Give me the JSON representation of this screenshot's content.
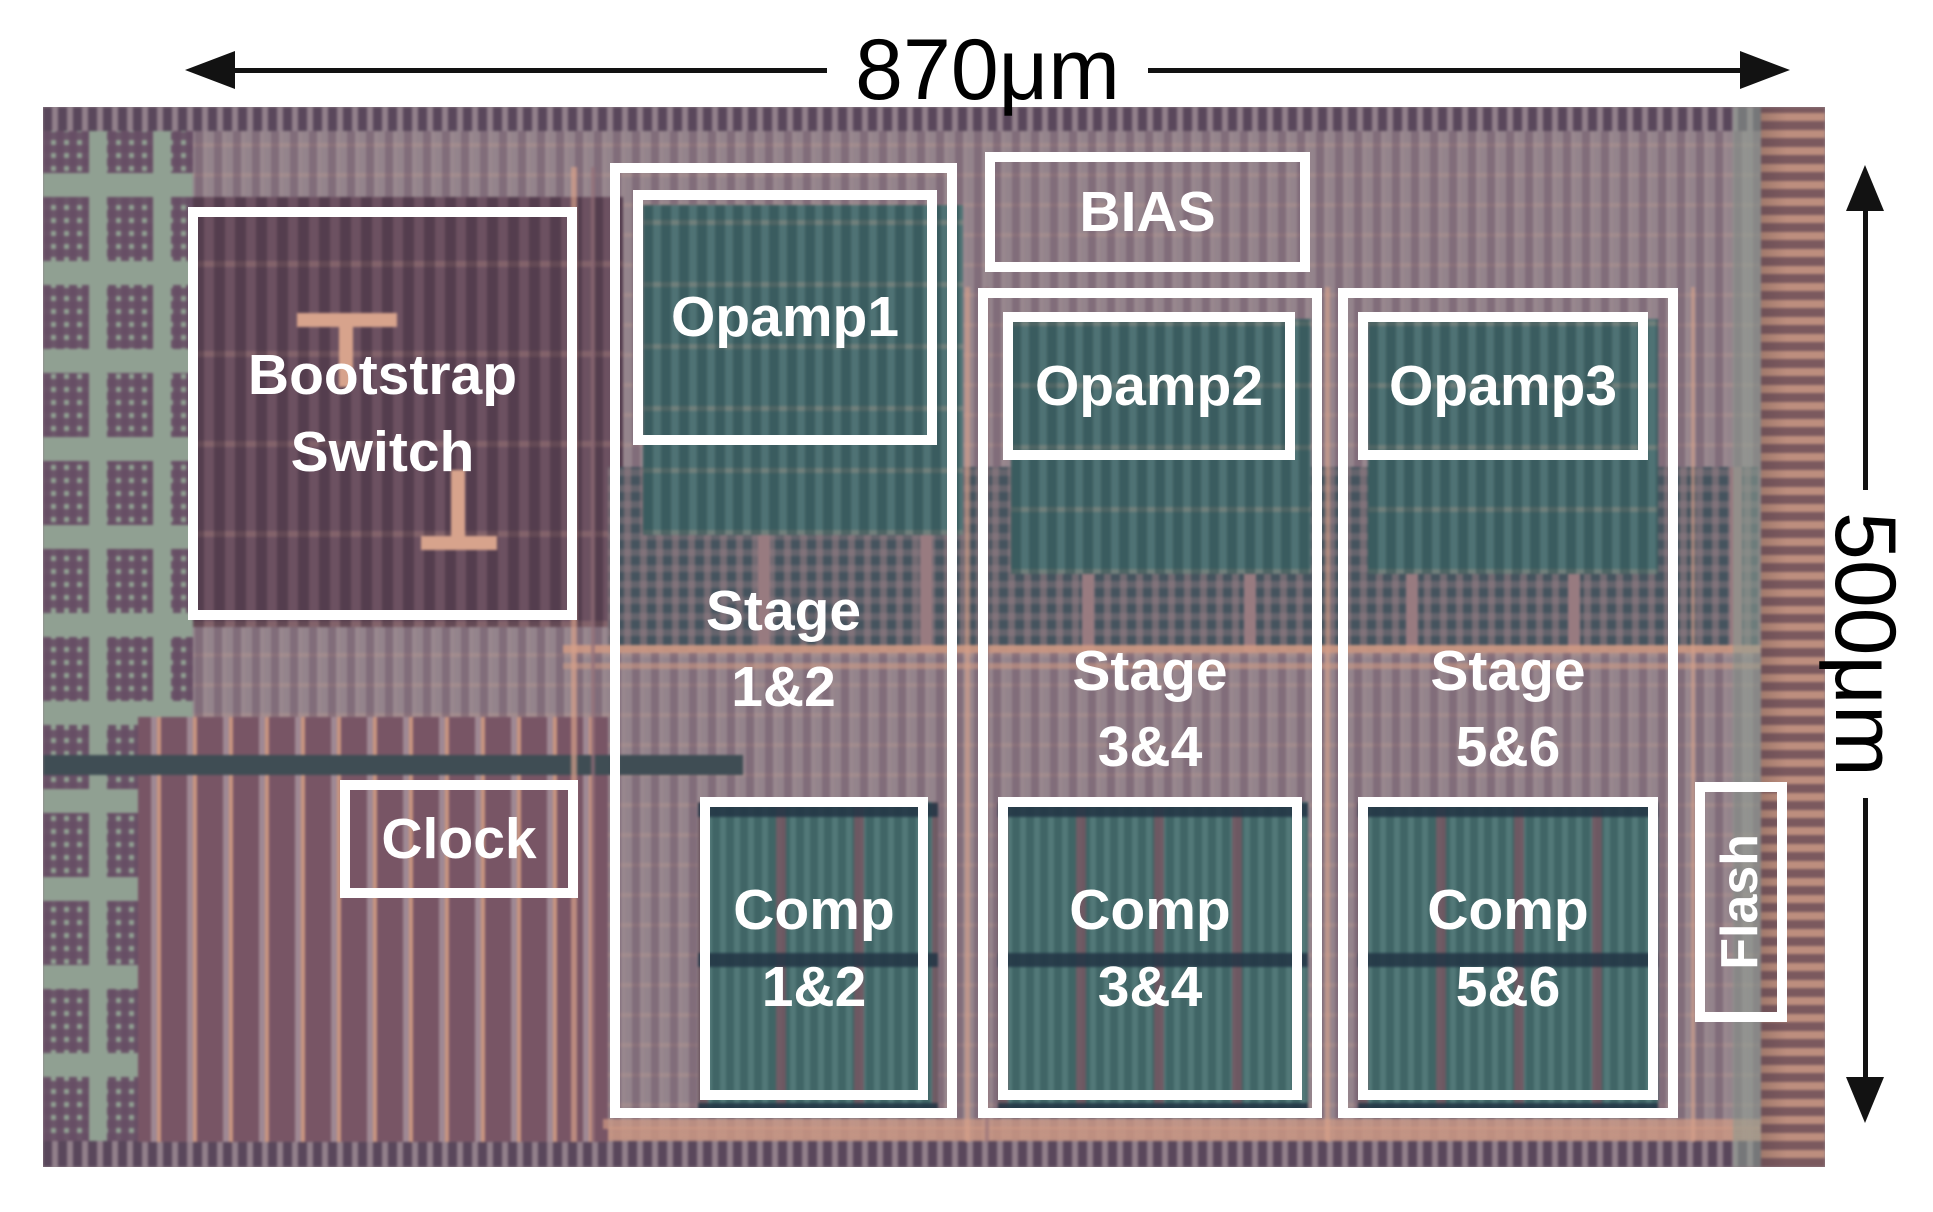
{
  "dimensions": {
    "width": "870μm",
    "height": "500μm"
  },
  "regions": {
    "bootstrap_switch": "Bootstrap\nSwitch",
    "clock": "Clock",
    "bias": "BIAS",
    "opamp1": "Opamp1",
    "opamp2": "Opamp2",
    "opamp3": "Opamp3",
    "stage12": "Stage\n1&2",
    "stage34": "Stage\n3&4",
    "stage56": "Stage\n5&6",
    "comp12": "Comp\n1&2",
    "comp34": "Comp\n3&4",
    "comp56": "Comp\n5&6",
    "flash": "Flash"
  },
  "colors": {
    "annotation_line": "#ffffff",
    "dimension_ink": "#121212",
    "die_base": "#94848c",
    "die_purple": "#6d5168",
    "die_salmon": "#d69a81",
    "die_teal": "#4e7577",
    "die_sage": "#90a193",
    "die_navy": "#3c4a52"
  }
}
